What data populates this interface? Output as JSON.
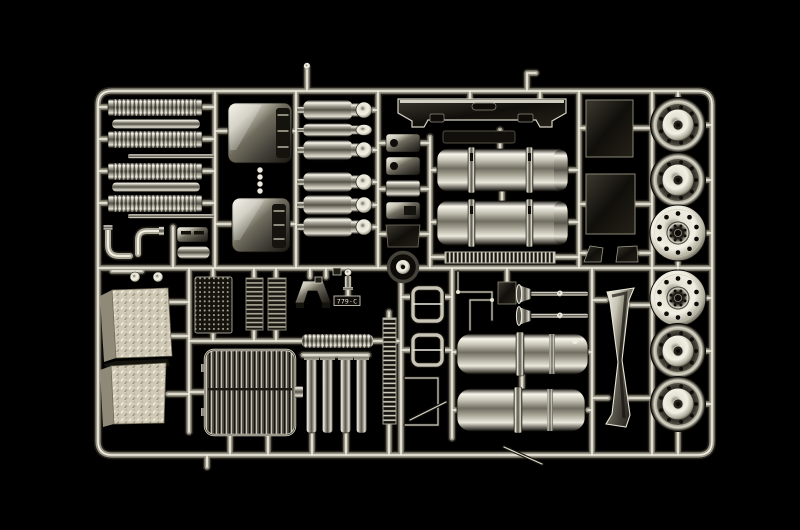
{
  "scene": {
    "type": "product-photograph",
    "subject": "chrome-plated plastic model kit sprue (parts tree) on black background",
    "background_color": "#000000",
    "sprue": {
      "code": "779·C",
      "finish": "mirror chrome plating",
      "palette": {
        "chrome_highlight": "#f6f4ea",
        "chrome_mid": "#908d7f",
        "chrome_shadow": "#13110d",
        "tread_plate": "#d6d0be",
        "smoke_chrome_dark": "#1c1a15"
      },
      "regions": {
        "top_left": [
          "ribbed exhaust silencer x4",
          "plain muffler tube x2",
          "mounting strip x2",
          "exhaust elbow pipe x2",
          "battery box lid",
          "storage box lid"
        ],
        "upper_middle": [
          "fuel tank side panel x2",
          "link chain connector",
          "air reservoir tank x6",
          "mounting bracket x5"
        ],
        "upper_right": [
          "front bumper",
          "license plate holder",
          "cylindrical fuel tank with straps x2",
          "tread catwalk strip",
          "tank mounting panel x2",
          "corner bracket x2"
        ],
        "wheel_column": [
          "dished wheel rim x4",
          "flat wheel hub disc x2"
        ],
        "lower_left": [
          "diamond tread step plate x2",
          "mesh screen panel",
          "slatted vent panel x2",
          "mudguard bracket",
          "valve fitting",
          "sprue code plate",
          "position tag x2",
          "twin dome caps bar"
        ],
        "lower_middle": [
          "radiator grille",
          "exhaust stack tube x4",
          "ribbed silencer",
          "ribbed channel strip",
          "spare pulley wheel",
          "suspension bracket x2",
          "air horn x2",
          "brake line pipe x2",
          "large air tank x2",
          "cab wind deflector",
          "antenna rod"
        ]
      }
    }
  }
}
